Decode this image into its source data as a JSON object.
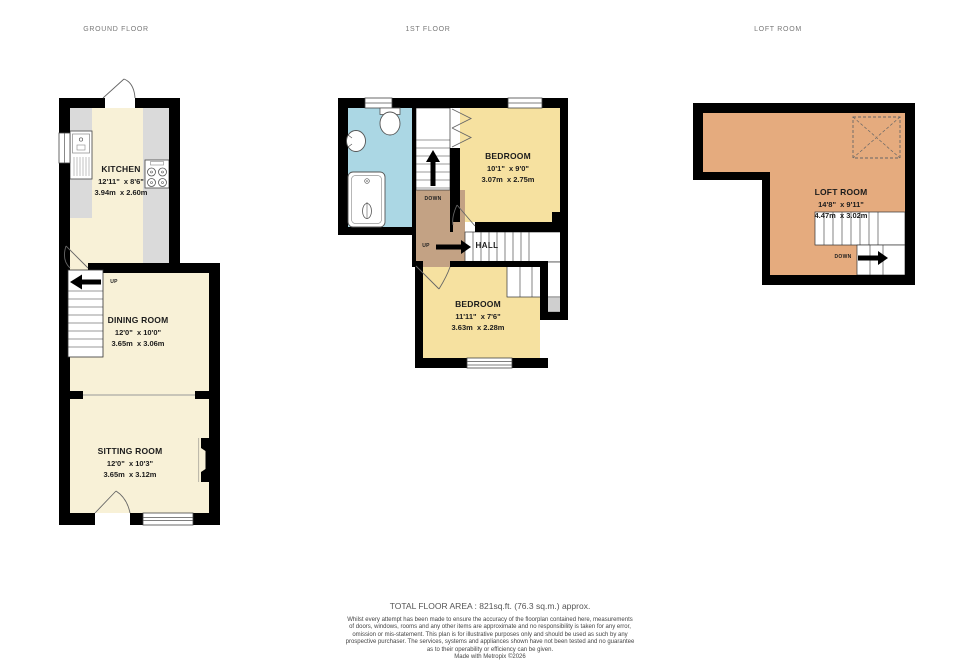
{
  "titles": {
    "ground": "GROUND FLOOR",
    "first": "1ST FLOOR",
    "loft": "LOFT ROOM"
  },
  "rooms": {
    "kitchen": {
      "name": "KITCHEN",
      "imperial": "12'11\"  x 8'6\"",
      "metric": "3.94m  x 2.60m"
    },
    "dining": {
      "name": "DINING ROOM",
      "imperial": "12'0\"  x 10'0\"",
      "metric": "3.65m  x 3.06m"
    },
    "sitting": {
      "name": "SITTING ROOM",
      "imperial": "12'0\"  x 10'3\"",
      "metric": "3.65m  x 3.12m"
    },
    "bedroom1": {
      "name": "BEDROOM",
      "imperial": "10'1\"  x 9'0\"",
      "metric": "3.07m  x 2.75m"
    },
    "bedroom2": {
      "name": "BEDROOM",
      "imperial": "11'11\"  x 7'6\"",
      "metric": "3.63m  x 2.28m"
    },
    "loft": {
      "name": "LOFT ROOM",
      "imperial": "14'8\"  x 9'11\"",
      "metric": "4.47m  x 3.02m"
    },
    "hall": {
      "name": "HALL"
    }
  },
  "stairs": {
    "ground_up": "UP",
    "first_down": "DOWN",
    "first_up": "UP",
    "loft_down": "DOWN"
  },
  "footer": {
    "total_area": "TOTAL FLOOR AREA : 821sq.ft. (76.3 sq.m.) approx.",
    "disclaimer": [
      "Whilst every attempt has been made to ensure the accuracy of the floorplan contained here, measurements",
      "of doors, windows, rooms and any other items are approximate and no responsibility is taken for any error,",
      "omission or mis-statement. This plan is for illustrative purposes only and should be used as such by any",
      "prospective purchaser. The services, systems and appliances shown have not been tested and no guarantee",
      "as to their operability or efficiency can be given."
    ],
    "credit": "Made with Metropix ©2026"
  },
  "colors": {
    "wall": "#000000",
    "floor_cream": "#f8f1d7",
    "floor_yellow": "#f6e1a0",
    "floor_blue": "#abd7e4",
    "floor_tan": "#c3a284",
    "floor_orange": "#e5ab7e",
    "counter_gray": "#dadada",
    "title_gray": "#787878"
  }
}
